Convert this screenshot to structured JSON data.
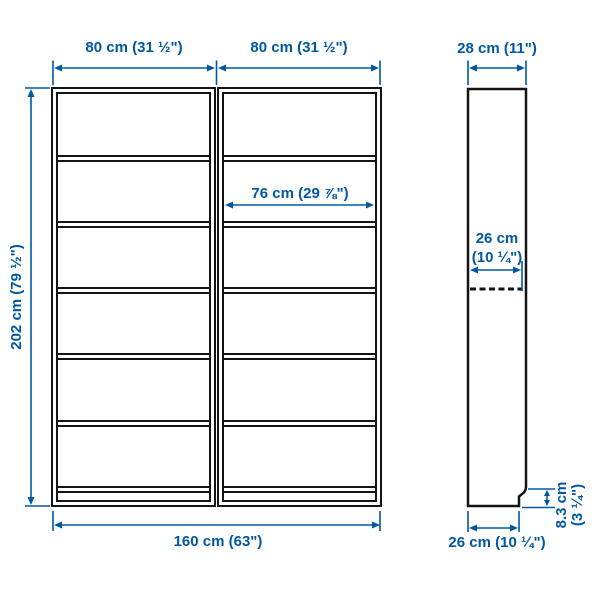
{
  "diagram": {
    "title": "bookcase-dimension-diagram",
    "colors": {
      "dimension_blue": "#0058a3",
      "outline_black": "#141414",
      "background": "#ffffff"
    },
    "front_view": {
      "unit_width_left": "80 cm (31 ½\")",
      "unit_width_right": "80 cm (31 ½\")",
      "total_height": "202 cm (79 ½\")",
      "inner_shelf_width": "76 cm (29 ⅞\")",
      "total_width": "160 cm (63\")",
      "shelf_rows_per_unit": 6,
      "units": 2
    },
    "side_view": {
      "total_depth": "28 cm (11\")",
      "shelf_depth_line1": "26 cm",
      "shelf_depth_line2": "(10 ¼\")",
      "plinth_height_line1": "8.3 cm",
      "plinth_height_line2": "(3 ¼\")",
      "base_depth": "26 cm (10 ¼\")"
    }
  }
}
